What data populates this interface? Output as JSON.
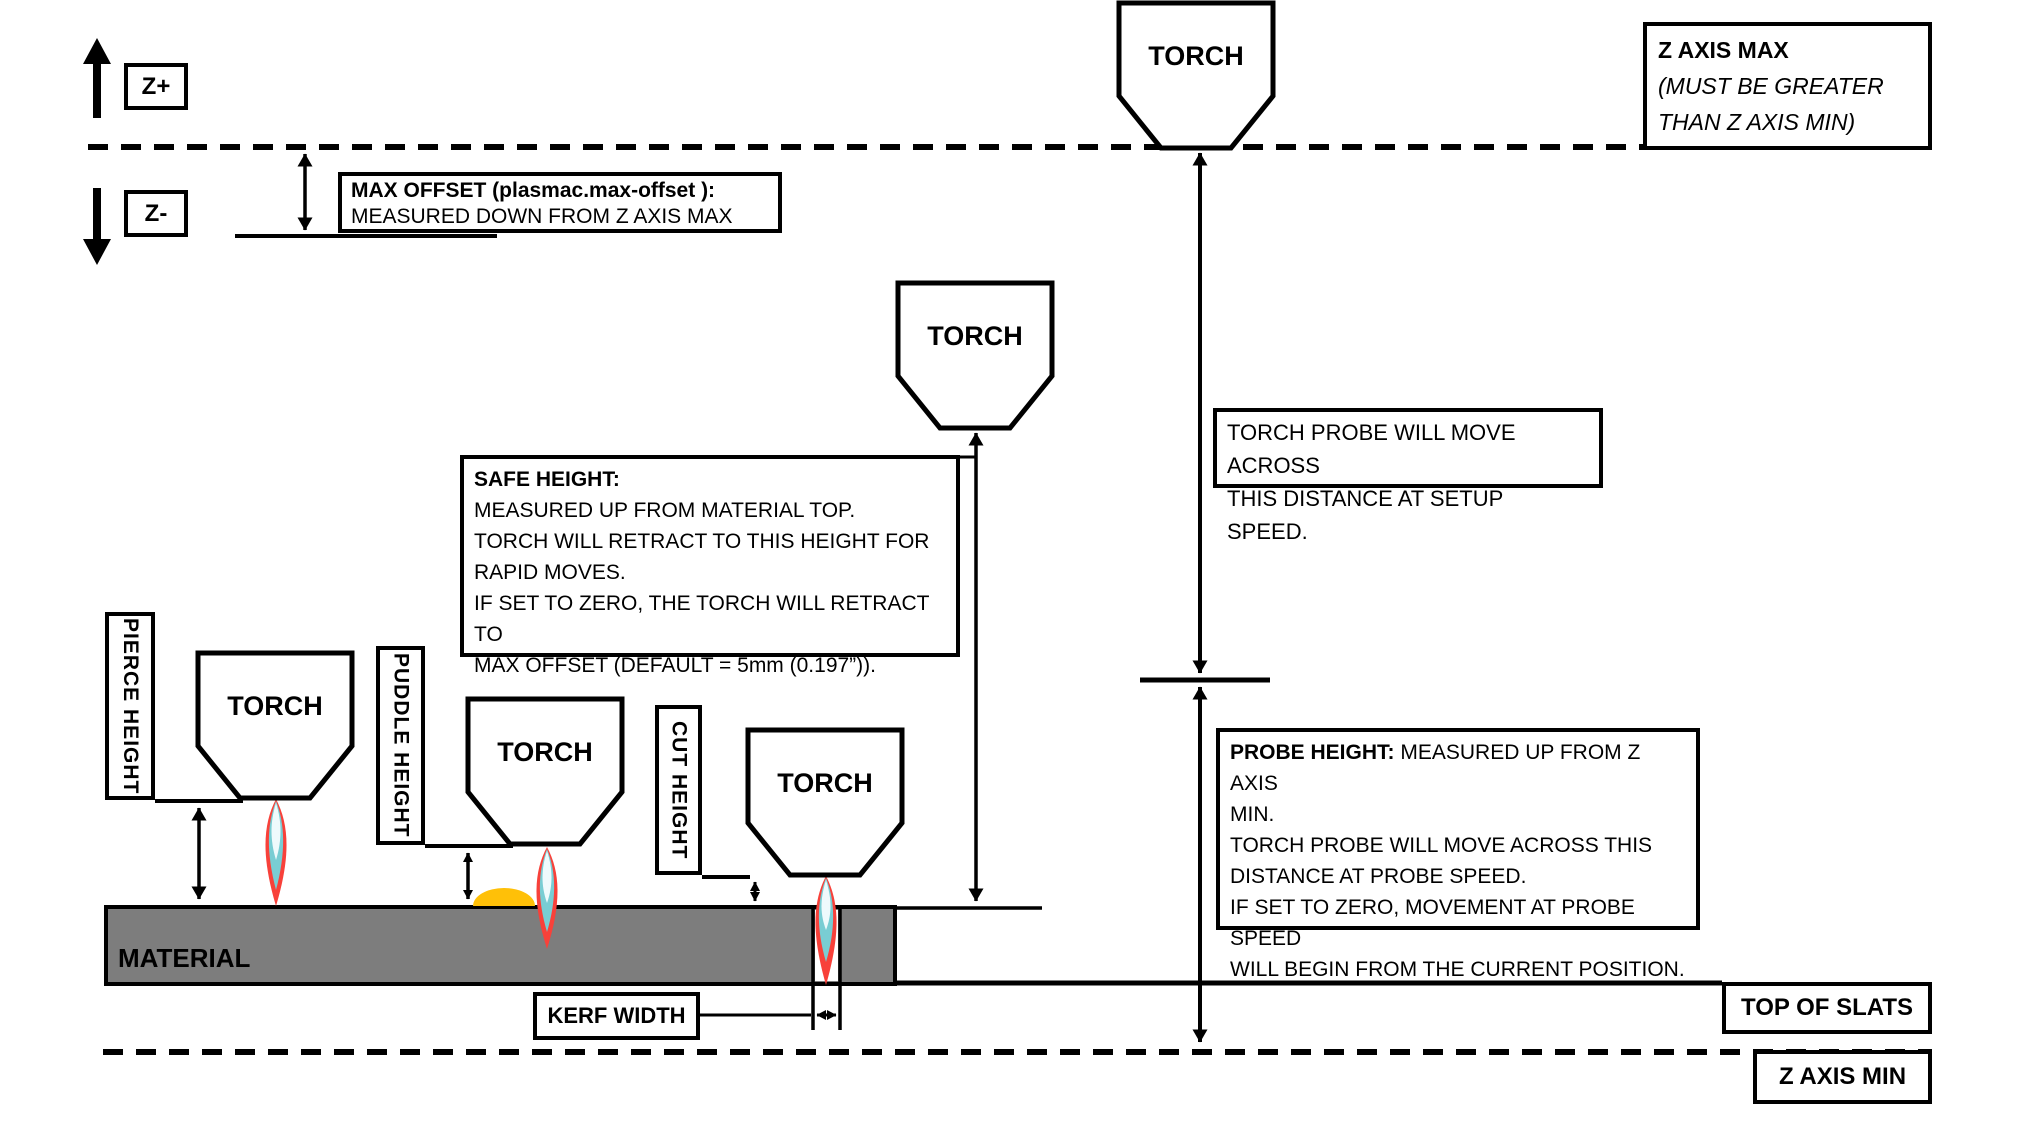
{
  "colors": {
    "line": "#000000",
    "material_fill": "#7d7d7d",
    "puddle_fill": "#ffc008",
    "flame_outer": "#f8413a",
    "flame_mid": "#79cdd3",
    "flame_inner": "#effafc",
    "background": "#ffffff"
  },
  "labels": {
    "torch": "TORCH",
    "z_plus": "Z+",
    "z_minus": "Z-",
    "material": "MATERIAL",
    "pierce_height": "PIERCE HEIGHT",
    "puddle_height": "PUDDLE HEIGHT",
    "cut_height": "CUT HEIGHT",
    "kerf_width": "KERF WIDTH",
    "top_of_slats": "TOP OF SLATS",
    "z_axis_min": "Z AXIS MIN"
  },
  "boxes": {
    "max_offset": {
      "title": "MAX OFFSET (plasmac.max-offset ):",
      "line": "MEASURED DOWN FROM Z AXIS MAX"
    },
    "z_axis_max": {
      "title": "Z AXIS MAX",
      "lines": [
        "(MUST BE GREATER",
        "THAN Z AXIS MIN)"
      ]
    },
    "torch_probe": {
      "lines": [
        "TORCH PROBE WILL MOVE ACROSS",
        "THIS DISTANCE AT SETUP SPEED."
      ]
    },
    "safe_height": {
      "title": "SAFE HEIGHT:",
      "lines": [
        "MEASURED UP FROM MATERIAL TOP.",
        "TORCH WILL RETRACT TO THIS HEIGHT FOR",
        "RAPID MOVES.",
        "IF SET TO ZERO, THE TORCH WILL RETRACT TO",
        "MAX OFFSET (DEFAULT = 5mm (0.197”))."
      ]
    },
    "probe_height": {
      "title": "PROBE HEIGHT:",
      "title_suffix": " MEASURED UP FROM Z AXIS",
      "lines": [
        "MIN.",
        "TORCH PROBE WILL MOVE ACROSS THIS",
        "DISTANCE AT PROBE SPEED.",
        "IF SET TO ZERO,  MOVEMENT AT PROBE SPEED",
        "WILL BEGIN FROM THE CURRENT POSITION."
      ]
    }
  }
}
